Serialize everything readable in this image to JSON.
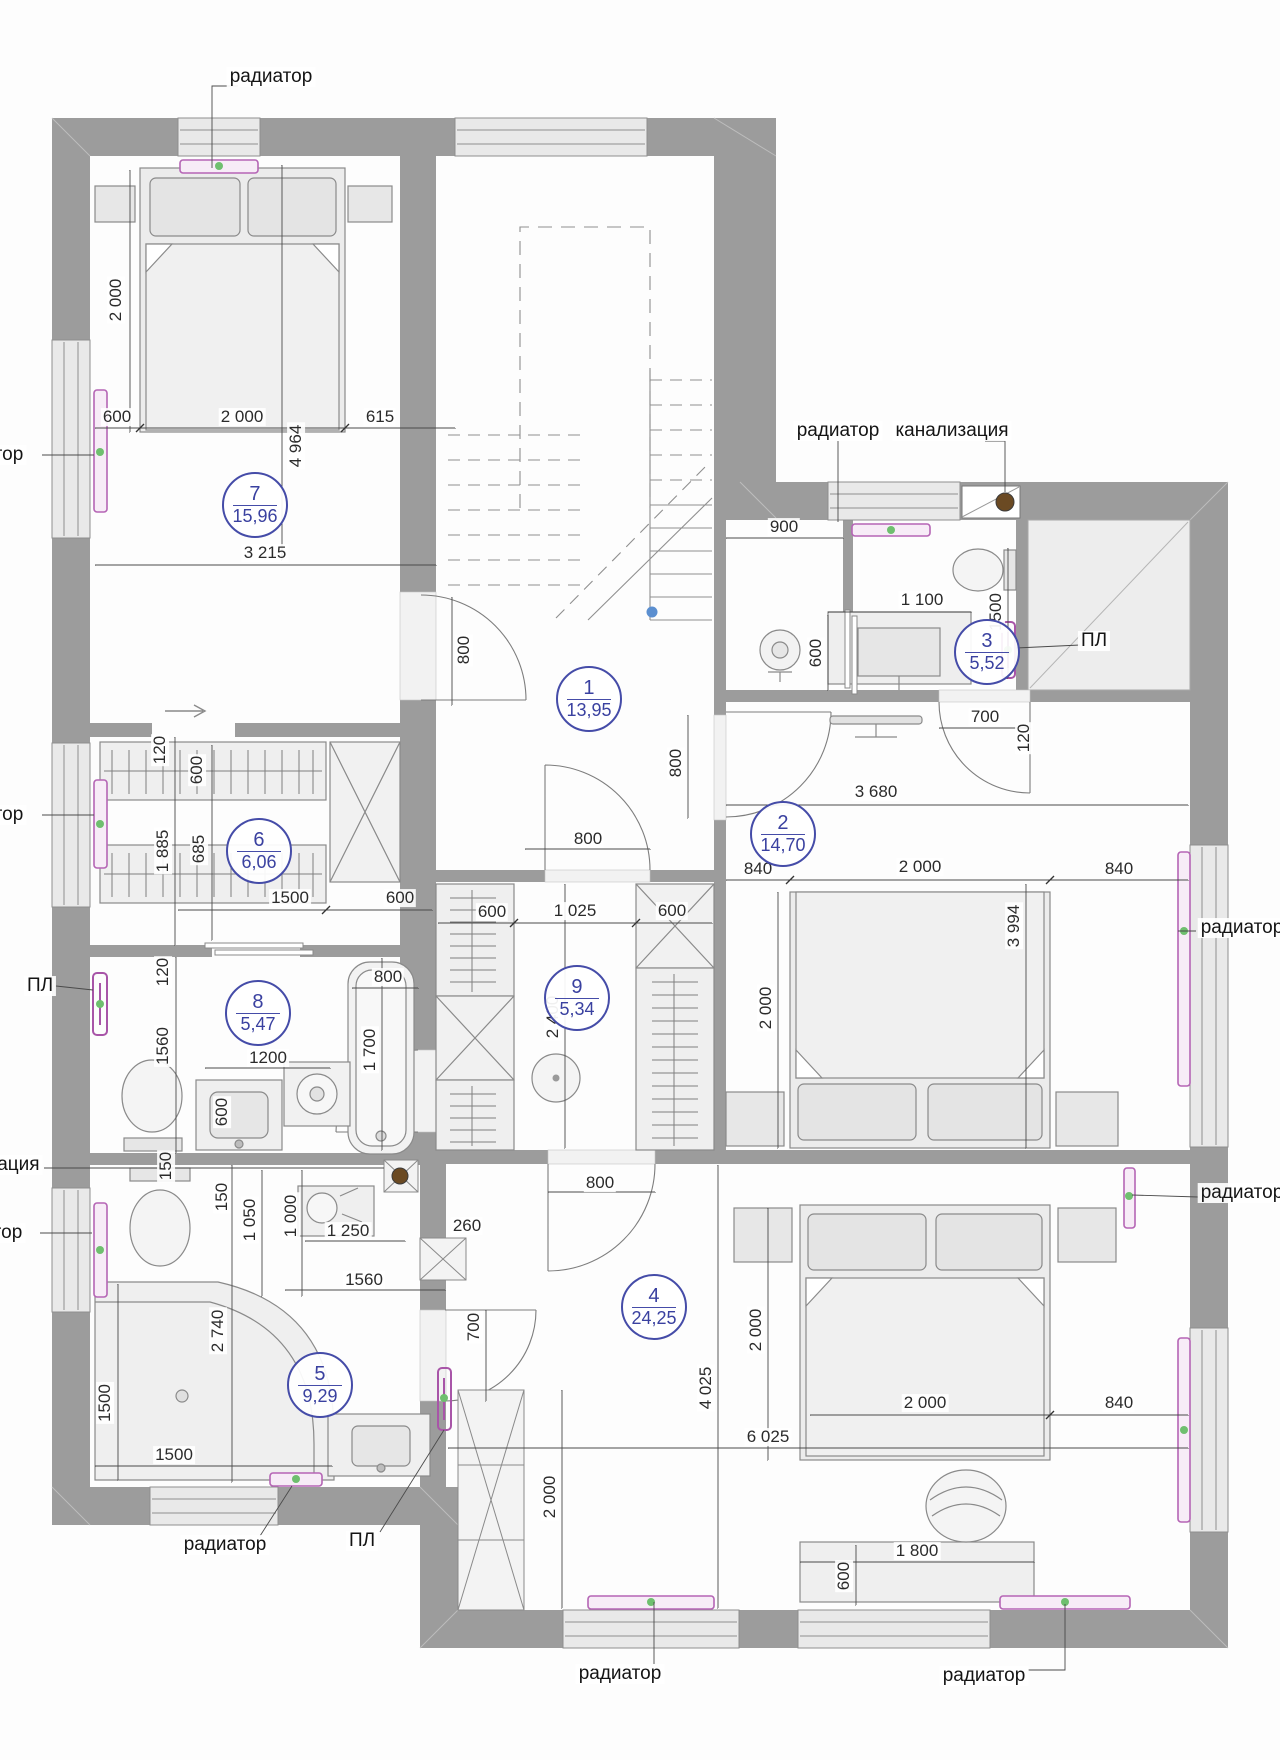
{
  "drawing": {
    "colors": {
      "wall": "#9c9c9c",
      "window": "#e9e9e9",
      "radiator": "#b565b5",
      "badge_blue": "#454CA8",
      "green_dot": "#6fbf6f",
      "blue_dot": "#5b8fd0",
      "sewer_brown": "#6b4a23"
    },
    "room_badges": [
      {
        "number": "1",
        "area": "13,95",
        "x": 587,
        "y": 697
      },
      {
        "number": "2",
        "area": "14,70",
        "x": 781,
        "y": 832
      },
      {
        "number": "3",
        "area": "5,52",
        "x": 985,
        "y": 650
      },
      {
        "number": "4",
        "area": "24,25",
        "x": 652,
        "y": 1305
      },
      {
        "number": "5",
        "area": "9,29",
        "x": 318,
        "y": 1383
      },
      {
        "number": "6",
        "area": "6,06",
        "x": 257,
        "y": 849
      },
      {
        "number": "7",
        "area": "15,96",
        "x": 253,
        "y": 503
      },
      {
        "number": "8",
        "area": "5,47",
        "x": 256,
        "y": 1011
      },
      {
        "number": "9",
        "area": "5,34",
        "x": 575,
        "y": 996
      }
    ],
    "dimensions": [
      {
        "text": "600",
        "x": 117,
        "y": 417,
        "rot": 0
      },
      {
        "text": "2 000",
        "x": 242,
        "y": 417,
        "rot": 0
      },
      {
        "text": "615",
        "x": 380,
        "y": 417,
        "rot": 0
      },
      {
        "text": "2 000",
        "x": 116,
        "y": 300,
        "rot": 1
      },
      {
        "text": "4 964",
        "x": 296,
        "y": 446,
        "rot": 1
      },
      {
        "text": "3 215",
        "x": 265,
        "y": 553,
        "rot": 0
      },
      {
        "text": "800",
        "x": 464,
        "y": 650,
        "rot": 1
      },
      {
        "text": "120",
        "x": 160,
        "y": 750,
        "rot": 1
      },
      {
        "text": "600",
        "x": 197,
        "y": 770,
        "rot": 1
      },
      {
        "text": "1 885",
        "x": 163,
        "y": 851,
        "rot": 1
      },
      {
        "text": "685",
        "x": 199,
        "y": 849,
        "rot": 1
      },
      {
        "text": "1500",
        "x": 290,
        "y": 898,
        "rot": 0
      },
      {
        "text": "600",
        "x": 400,
        "y": 898,
        "rot": 0
      },
      {
        "text": "120",
        "x": 163,
        "y": 972,
        "rot": 1
      },
      {
        "text": "800",
        "x": 388,
        "y": 977,
        "rot": 0
      },
      {
        "text": "1560",
        "x": 163,
        "y": 1046,
        "rot": 1
      },
      {
        "text": "1 700",
        "x": 370,
        "y": 1050,
        "rot": 1
      },
      {
        "text": "1200",
        "x": 268,
        "y": 1058,
        "rot": 0
      },
      {
        "text": "600",
        "x": 222,
        "y": 1112,
        "rot": 1
      },
      {
        "text": "150",
        "x": 166,
        "y": 1166,
        "rot": 1
      },
      {
        "text": "150",
        "x": 222,
        "y": 1197,
        "rot": 1
      },
      {
        "text": "1 050",
        "x": 250,
        "y": 1220,
        "rot": 1
      },
      {
        "text": "1 000",
        "x": 291,
        "y": 1216,
        "rot": 1
      },
      {
        "text": "1 250",
        "x": 348,
        "y": 1231,
        "rot": 0
      },
      {
        "text": "1560",
        "x": 364,
        "y": 1280,
        "rot": 0
      },
      {
        "text": "2 740",
        "x": 218,
        "y": 1331,
        "rot": 1
      },
      {
        "text": "260",
        "x": 467,
        "y": 1226,
        "rot": 0
      },
      {
        "text": "1500",
        "x": 105,
        "y": 1403,
        "rot": 1
      },
      {
        "text": "1500",
        "x": 174,
        "y": 1455,
        "rot": 0
      },
      {
        "text": "700",
        "x": 474,
        "y": 1327,
        "rot": 1
      },
      {
        "text": "900",
        "x": 784,
        "y": 527,
        "rot": 0
      },
      {
        "text": "1 100",
        "x": 922,
        "y": 600,
        "rot": 0
      },
      {
        "text": "600",
        "x": 816,
        "y": 653,
        "rot": 1
      },
      {
        "text": "1500",
        "x": 996,
        "y": 612,
        "rot": 1
      },
      {
        "text": "700",
        "x": 985,
        "y": 717,
        "rot": 0
      },
      {
        "text": "120",
        "x": 1024,
        "y": 738,
        "rot": 1
      },
      {
        "text": "800",
        "x": 676,
        "y": 763,
        "rot": 1
      },
      {
        "text": "3 680",
        "x": 876,
        "y": 792,
        "rot": 0
      },
      {
        "text": "840",
        "x": 758,
        "y": 869,
        "rot": 0
      },
      {
        "text": "2 000",
        "x": 920,
        "y": 867,
        "rot": 0
      },
      {
        "text": "840",
        "x": 1119,
        "y": 869,
        "rot": 0
      },
      {
        "text": "3 994",
        "x": 1014,
        "y": 926,
        "rot": 1
      },
      {
        "text": "2 000",
        "x": 766,
        "y": 1008,
        "rot": 1
      },
      {
        "text": "800",
        "x": 588,
        "y": 839,
        "rot": 0
      },
      {
        "text": "600",
        "x": 492,
        "y": 912,
        "rot": 0
      },
      {
        "text": "1 025",
        "x": 575,
        "y": 911,
        "rot": 0
      },
      {
        "text": "600",
        "x": 672,
        "y": 911,
        "rot": 0
      },
      {
        "text": "2 400",
        "x": 553,
        "y": 1017,
        "rot": 1
      },
      {
        "text": "800",
        "x": 600,
        "y": 1183,
        "rot": 0
      },
      {
        "text": "2 000",
        "x": 756,
        "y": 1330,
        "rot": 1
      },
      {
        "text": "2 000",
        "x": 925,
        "y": 1403,
        "rot": 0
      },
      {
        "text": "840",
        "x": 1119,
        "y": 1403,
        "rot": 0
      },
      {
        "text": "4 025",
        "x": 706,
        "y": 1388,
        "rot": 1
      },
      {
        "text": "6 025",
        "x": 768,
        "y": 1437,
        "rot": 0
      },
      {
        "text": "2 000",
        "x": 550,
        "y": 1497,
        "rot": 1
      },
      {
        "text": "1 800",
        "x": 917,
        "y": 1551,
        "rot": 0
      },
      {
        "text": "600",
        "x": 844,
        "y": 1576,
        "rot": 1
      }
    ],
    "labels": [
      {
        "text": "радиатор",
        "x": 271,
        "y": 77
      },
      {
        "text": "радиатор",
        "x": 838,
        "y": 431
      },
      {
        "text": "канализация",
        "x": 952,
        "y": 431
      },
      {
        "text": "ПЛ",
        "x": 1094,
        "y": 641
      },
      {
        "text": "радиатор",
        "x": 1242,
        "y": 928
      },
      {
        "text": "радиатор",
        "x": 1242,
        "y": 1193
      },
      {
        "text": "радиатор",
        "x": -18,
        "y": 455
      },
      {
        "text": "радиатор",
        "x": -18,
        "y": 815
      },
      {
        "text": "ПЛ",
        "x": 40,
        "y": 986
      },
      {
        "text": "канализация",
        "x": -17,
        "y": 1165
      },
      {
        "text": "радиатор",
        "x": -19,
        "y": 1233
      },
      {
        "text": "радиатор",
        "x": 225,
        "y": 1545
      },
      {
        "text": "ПЛ",
        "x": 362,
        "y": 1541
      },
      {
        "text": "радиатор",
        "x": 620,
        "y": 1674
      },
      {
        "text": "радиатор",
        "x": 984,
        "y": 1676
      }
    ]
  }
}
